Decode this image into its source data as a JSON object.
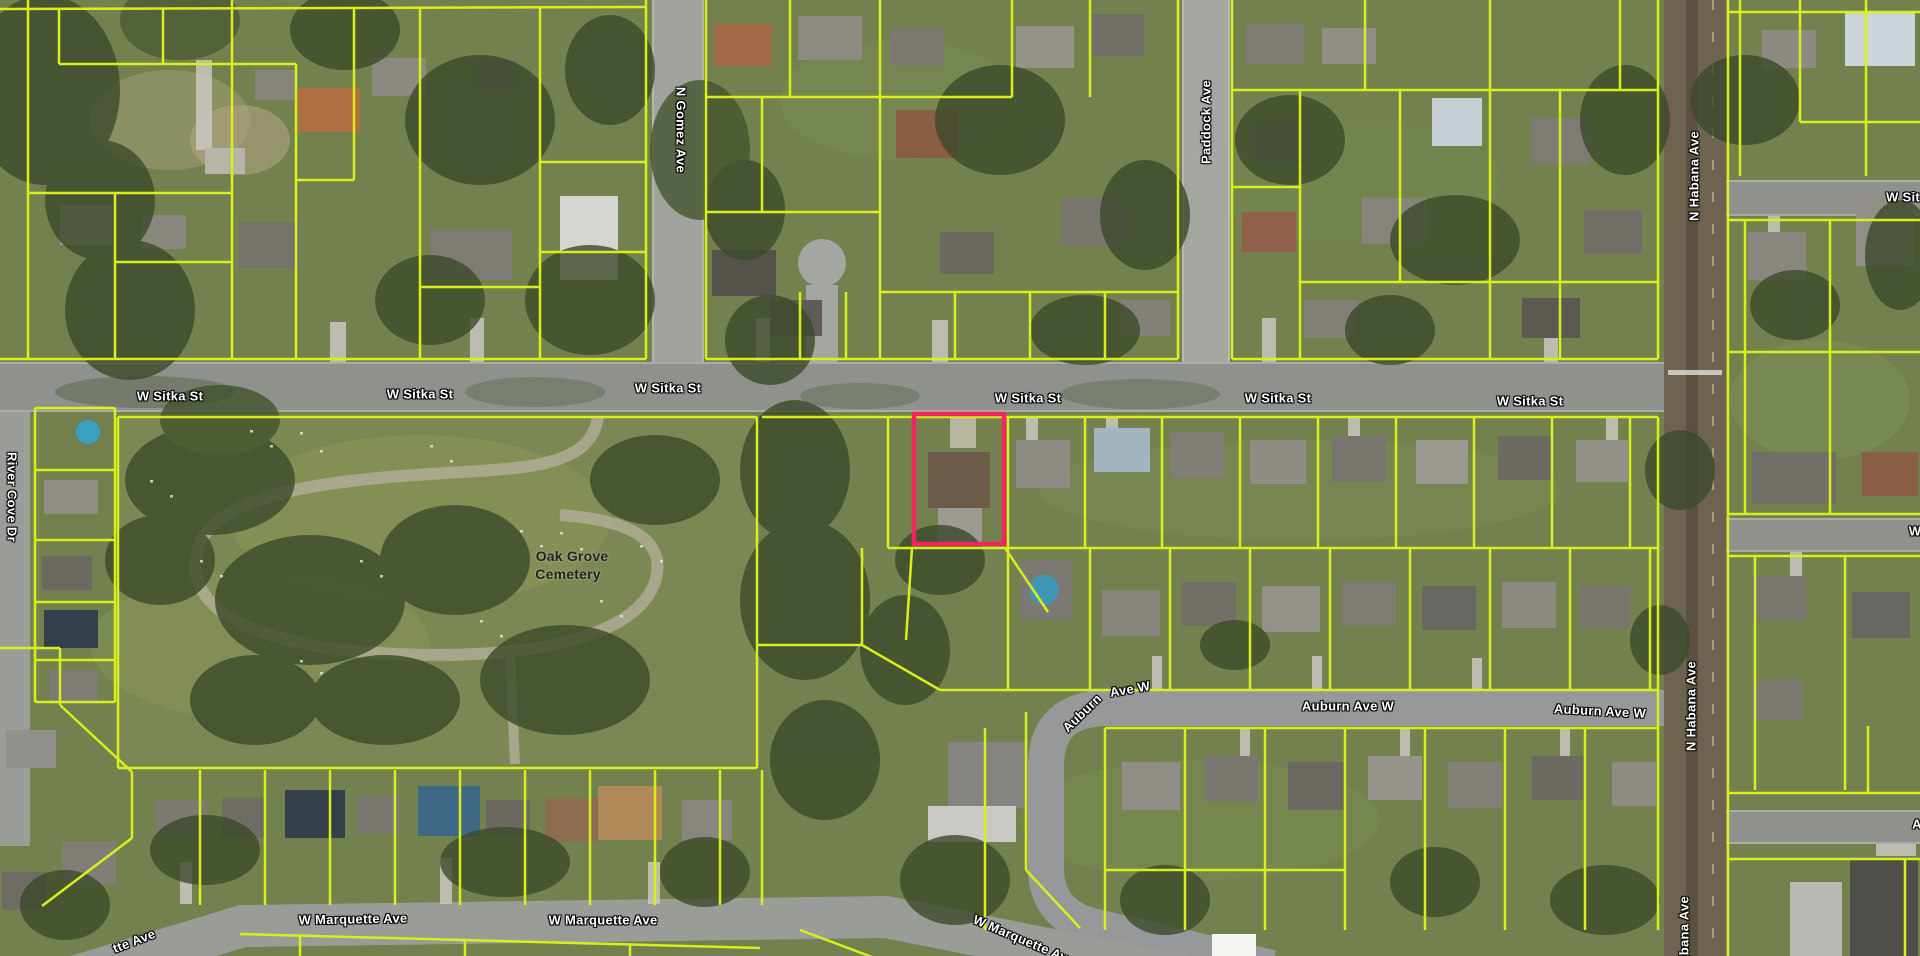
{
  "map": {
    "description": "Aerial parcel map with highlighted property",
    "colors": {
      "parcel_line": "#d9ef1a",
      "highlight": "#f2265f",
      "road": "#969894",
      "label_text": "#ffffff"
    },
    "highlight_parcel": {
      "x": 914,
      "y": 414,
      "w": 90,
      "h": 130
    },
    "labels": [
      {
        "text": "W Sitka St",
        "x": 170,
        "y": 396,
        "rot": 0,
        "kind": "street"
      },
      {
        "text": "W Sitka St",
        "x": 420,
        "y": 394,
        "rot": 0,
        "kind": "street"
      },
      {
        "text": "W Sitka St",
        "x": 668,
        "y": 388,
        "rot": 0,
        "kind": "street"
      },
      {
        "text": "W Sitka St",
        "x": 1028,
        "y": 398,
        "rot": 0,
        "kind": "street"
      },
      {
        "text": "W Sitka St",
        "x": 1278,
        "y": 398,
        "rot": 0,
        "kind": "street"
      },
      {
        "text": "W Sitka St",
        "x": 1530,
        "y": 401,
        "rot": 0,
        "kind": "street"
      },
      {
        "text": "W Sit",
        "x": 1903,
        "y": 197,
        "rot": 0,
        "kind": "street"
      },
      {
        "text": "N Gomez Ave",
        "x": 681,
        "y": 130,
        "rot": 90,
        "kind": "street"
      },
      {
        "text": "Paddock Ave",
        "x": 1206,
        "y": 122,
        "rot": -90,
        "kind": "street"
      },
      {
        "text": "N Habana Ave",
        "x": 1694,
        "y": 176,
        "rot": -90,
        "kind": "street"
      },
      {
        "text": "N Habana Ave",
        "x": 1691,
        "y": 706,
        "rot": -90,
        "kind": "street"
      },
      {
        "text": "N Habana Ave",
        "x": 1684,
        "y": 941,
        "rot": -90,
        "kind": "street"
      },
      {
        "text": "River Cove Dr",
        "x": 12,
        "y": 497,
        "rot": 90,
        "kind": "street"
      },
      {
        "text": "Auburn",
        "x": 1082,
        "y": 713,
        "rot": -44,
        "kind": "street"
      },
      {
        "text": "Ave W",
        "x": 1130,
        "y": 689,
        "rot": -10,
        "kind": "street"
      },
      {
        "text": "Auburn Ave W",
        "x": 1348,
        "y": 706,
        "rot": 0,
        "kind": "street"
      },
      {
        "text": "Auburn Ave W",
        "x": 1600,
        "y": 711,
        "rot": 3,
        "kind": "street"
      },
      {
        "text": "W Marquette Ave",
        "x": 353,
        "y": 919,
        "rot": -1,
        "kind": "street"
      },
      {
        "text": "W Marquette Ave",
        "x": 603,
        "y": 920,
        "rot": 0,
        "kind": "street"
      },
      {
        "text": "W Marquette Ave",
        "x": 1024,
        "y": 940,
        "rot": 23,
        "kind": "street"
      },
      {
        "text": "tte Ave",
        "x": 134,
        "y": 941,
        "rot": -21,
        "kind": "street"
      },
      {
        "text": "W",
        "x": 1915,
        "y": 531,
        "rot": 0,
        "kind": "street"
      },
      {
        "text": "A",
        "x": 1917,
        "y": 824,
        "rot": 0,
        "kind": "street"
      },
      {
        "text": "Oak Grove",
        "x": 572,
        "y": 556,
        "rot": 0,
        "kind": "place"
      },
      {
        "text": "Cemetery",
        "x": 568,
        "y": 574,
        "rot": 0,
        "kind": "place"
      }
    ],
    "parcel_lines": [
      [
        [
          28,
          0
        ],
        [
          28,
          359
        ]
      ],
      [
        [
          0,
          9
        ],
        [
          646,
          7
        ]
      ],
      [
        [
          59,
          9
        ],
        [
          59,
          64
        ]
      ],
      [
        [
          59,
          64
        ],
        [
          232,
          64
        ]
      ],
      [
        [
          163,
          9
        ],
        [
          163,
          64
        ]
      ],
      [
        [
          232,
          0
        ],
        [
          232,
          193
        ]
      ],
      [
        [
          28,
          193
        ],
        [
          232,
          193
        ]
      ],
      [
        [
          232,
          64
        ],
        [
          296,
          64
        ]
      ],
      [
        [
          296,
          64
        ],
        [
          296,
          359
        ]
      ],
      [
        [
          115,
          193
        ],
        [
          115,
          359
        ]
      ],
      [
        [
          115,
          262
        ],
        [
          232,
          262
        ]
      ],
      [
        [
          232,
          193
        ],
        [
          232,
          359
        ]
      ],
      [
        [
          354,
          7
        ],
        [
          354,
          180
        ]
      ],
      [
        [
          296,
          180
        ],
        [
          354,
          180
        ]
      ],
      [
        [
          420,
          7
        ],
        [
          420,
          359
        ]
      ],
      [
        [
          420,
          287
        ],
        [
          540,
          287
        ]
      ],
      [
        [
          540,
          7
        ],
        [
          540,
          359
        ]
      ],
      [
        [
          646,
          0
        ],
        [
          646,
          359
        ]
      ],
      [
        [
          540,
          162
        ],
        [
          646,
          162
        ]
      ],
      [
        [
          540,
          252
        ],
        [
          646,
          252
        ]
      ],
      [
        [
          0,
          359
        ],
        [
          646,
          359
        ]
      ],
      [
        [
          706,
          359
        ],
        [
          1178,
          359
        ]
      ],
      [
        [
          1232,
          359
        ],
        [
          1658,
          359
        ]
      ],
      [
        [
          706,
          0
        ],
        [
          706,
          359
        ]
      ],
      [
        [
          790,
          0
        ],
        [
          790,
          97
        ]
      ],
      [
        [
          880,
          0
        ],
        [
          880,
          359
        ]
      ],
      [
        [
          706,
          97
        ],
        [
          880,
          97
        ]
      ],
      [
        [
          762,
          97
        ],
        [
          762,
          212
        ]
      ],
      [
        [
          706,
          212
        ],
        [
          880,
          212
        ]
      ],
      [
        [
          1012,
          0
        ],
        [
          1012,
          97
        ]
      ],
      [
        [
          880,
          97
        ],
        [
          1012,
          97
        ]
      ],
      [
        [
          1090,
          0
        ],
        [
          1090,
          97
        ]
      ],
      [
        [
          880,
          292
        ],
        [
          1178,
          292
        ]
      ],
      [
        [
          955,
          292
        ],
        [
          955,
          359
        ]
      ],
      [
        [
          1030,
          292
        ],
        [
          1030,
          359
        ]
      ],
      [
        [
          1105,
          292
        ],
        [
          1105,
          359
        ]
      ],
      [
        [
          1178,
          0
        ],
        [
          1178,
          359
        ]
      ],
      [
        [
          800,
          292
        ],
        [
          800,
          359
        ]
      ],
      [
        [
          846,
          292
        ],
        [
          846,
          359
        ]
      ],
      [
        [
          1232,
          0
        ],
        [
          1232,
          359
        ]
      ],
      [
        [
          1658,
          0
        ],
        [
          1658,
          359
        ]
      ],
      [
        [
          1232,
          90
        ],
        [
          1658,
          90
        ]
      ],
      [
        [
          1300,
          90
        ],
        [
          1300,
          359
        ]
      ],
      [
        [
          1365,
          0
        ],
        [
          1365,
          90
        ]
      ],
      [
        [
          1490,
          0
        ],
        [
          1490,
          359
        ]
      ],
      [
        [
          1560,
          90
        ],
        [
          1560,
          359
        ]
      ],
      [
        [
          1620,
          0
        ],
        [
          1620,
          90
        ]
      ],
      [
        [
          1232,
          187
        ],
        [
          1300,
          187
        ]
      ],
      [
        [
          1300,
          282
        ],
        [
          1658,
          282
        ]
      ],
      [
        [
          1400,
          90
        ],
        [
          1400,
          282
        ]
      ],
      [
        [
          1728,
          12
        ],
        [
          1920,
          12
        ]
      ],
      [
        [
          1740,
          0
        ],
        [
          1740,
          176
        ]
      ],
      [
        [
          1800,
          0
        ],
        [
          1800,
          122
        ]
      ],
      [
        [
          1866,
          0
        ],
        [
          1866,
          176
        ]
      ],
      [
        [
          1800,
          122
        ],
        [
          1920,
          122
        ]
      ],
      [
        [
          1728,
          220
        ],
        [
          1920,
          220
        ]
      ],
      [
        [
          1745,
          220
        ],
        [
          1745,
          514
        ]
      ],
      [
        [
          1830,
          220
        ],
        [
          1830,
          514
        ]
      ],
      [
        [
          1728,
          352
        ],
        [
          1920,
          352
        ]
      ],
      [
        [
          1728,
          514
        ],
        [
          1920,
          514
        ]
      ],
      [
        [
          1728,
          556
        ],
        [
          1920,
          556
        ]
      ],
      [
        [
          1755,
          556
        ],
        [
          1755,
          790
        ]
      ],
      [
        [
          1845,
          556
        ],
        [
          1845,
          790
        ]
      ],
      [
        [
          1728,
          793
        ],
        [
          1920,
          793
        ]
      ],
      [
        [
          1728,
          859
        ],
        [
          1920,
          859
        ]
      ],
      [
        [
          1868,
          726
        ],
        [
          1868,
          793
        ]
      ],
      [
        [
          1905,
          859
        ],
        [
          1905,
          956
        ]
      ],
      [
        [
          1728,
          0
        ],
        [
          1728,
          956
        ]
      ],
      [
        [
          118,
          417
        ],
        [
          757,
          417
        ]
      ],
      [
        [
          118,
          417
        ],
        [
          118,
          768
        ]
      ],
      [
        [
          757,
          417
        ],
        [
          757,
          768
        ]
      ],
      [
        [
          118,
          768
        ],
        [
          757,
          768
        ]
      ],
      [
        [
          35,
          408
        ],
        [
          115,
          408
        ]
      ],
      [
        [
          35,
          408
        ],
        [
          35,
          702
        ]
      ],
      [
        [
          115,
          408
        ],
        [
          115,
          702
        ]
      ],
      [
        [
          35,
          470
        ],
        [
          115,
          470
        ]
      ],
      [
        [
          35,
          540
        ],
        [
          115,
          540
        ]
      ],
      [
        [
          35,
          602
        ],
        [
          115,
          602
        ]
      ],
      [
        [
          35,
          660
        ],
        [
          115,
          660
        ]
      ],
      [
        [
          35,
          702
        ],
        [
          115,
          702
        ]
      ],
      [
        [
          0,
          648
        ],
        [
          60,
          648
        ]
      ],
      [
        [
          60,
          648
        ],
        [
          60,
          705
        ]
      ],
      [
        [
          60,
          705
        ],
        [
          132,
          772
        ]
      ],
      [
        [
          132,
          772
        ],
        [
          132,
          838
        ]
      ],
      [
        [
          132,
          838
        ],
        [
          42,
          906
        ]
      ],
      [
        [
          762,
          417
        ],
        [
          1658,
          417
        ]
      ],
      [
        [
          888,
          417
        ],
        [
          888,
          548
        ]
      ],
      [
        [
          1008,
          417
        ],
        [
          1008,
          548
        ]
      ],
      [
        [
          1085,
          417
        ],
        [
          1085,
          548
        ]
      ],
      [
        [
          1162,
          417
        ],
        [
          1162,
          548
        ]
      ],
      [
        [
          1240,
          417
        ],
        [
          1240,
          548
        ]
      ],
      [
        [
          1318,
          417
        ],
        [
          1318,
          548
        ]
      ],
      [
        [
          1396,
          417
        ],
        [
          1396,
          548
        ]
      ],
      [
        [
          1474,
          417
        ],
        [
          1474,
          548
        ]
      ],
      [
        [
          1552,
          417
        ],
        [
          1552,
          548
        ]
      ],
      [
        [
          1630,
          417
        ],
        [
          1630,
          548
        ]
      ],
      [
        [
          888,
          548
        ],
        [
          1658,
          548
        ]
      ],
      [
        [
          1008,
          548
        ],
        [
          1008,
          690
        ]
      ],
      [
        [
          1090,
          548
        ],
        [
          1090,
          690
        ]
      ],
      [
        [
          1170,
          548
        ],
        [
          1170,
          690
        ]
      ],
      [
        [
          1250,
          548
        ],
        [
          1250,
          690
        ]
      ],
      [
        [
          1330,
          548
        ],
        [
          1330,
          690
        ]
      ],
      [
        [
          1410,
          548
        ],
        [
          1410,
          690
        ]
      ],
      [
        [
          1490,
          548
        ],
        [
          1490,
          690
        ]
      ],
      [
        [
          1570,
          548
        ],
        [
          1570,
          690
        ]
      ],
      [
        [
          1650,
          548
        ],
        [
          1650,
          690
        ]
      ],
      [
        [
          940,
          690
        ],
        [
          1658,
          690
        ]
      ],
      [
        [
          862,
          548
        ],
        [
          862,
          645
        ]
      ],
      [
        [
          757,
          645
        ],
        [
          862,
          645
        ]
      ],
      [
        [
          862,
          645
        ],
        [
          940,
          690
        ]
      ],
      [
        [
          912,
          548
        ],
        [
          906,
          640
        ]
      ],
      [
        [
          1005,
          548
        ],
        [
          1048,
          612
        ]
      ],
      [
        [
          1105,
          728
        ],
        [
          1658,
          728
        ]
      ],
      [
        [
          1105,
          728
        ],
        [
          1105,
          930
        ]
      ],
      [
        [
          1185,
          728
        ],
        [
          1185,
          930
        ]
      ],
      [
        [
          1265,
          728
        ],
        [
          1265,
          930
        ]
      ],
      [
        [
          1345,
          728
        ],
        [
          1345,
          930
        ]
      ],
      [
        [
          1425,
          728
        ],
        [
          1425,
          930
        ]
      ],
      [
        [
          1505,
          728
        ],
        [
          1505,
          930
        ]
      ],
      [
        [
          1585,
          728
        ],
        [
          1585,
          930
        ]
      ],
      [
        [
          1105,
          870
        ],
        [
          1345,
          870
        ]
      ],
      [
        [
          1658,
          417
        ],
        [
          1658,
          930
        ]
      ],
      [
        [
          985,
          728
        ],
        [
          985,
          930
        ]
      ],
      [
        [
          762,
          770
        ],
        [
          762,
          905
        ]
      ],
      [
        [
          200,
          770
        ],
        [
          200,
          905
        ]
      ],
      [
        [
          265,
          770
        ],
        [
          265,
          905
        ]
      ],
      [
        [
          330,
          770
        ],
        [
          330,
          905
        ]
      ],
      [
        [
          395,
          770
        ],
        [
          395,
          905
        ]
      ],
      [
        [
          460,
          770
        ],
        [
          460,
          905
        ]
      ],
      [
        [
          525,
          770
        ],
        [
          525,
          905
        ]
      ],
      [
        [
          590,
          770
        ],
        [
          590,
          905
        ]
      ],
      [
        [
          655,
          770
        ],
        [
          655,
          905
        ]
      ],
      [
        [
          720,
          770
        ],
        [
          720,
          905
        ]
      ],
      [
        [
          240,
          934
        ],
        [
          760,
          948
        ]
      ],
      [
        [
          300,
          936
        ],
        [
          300,
          956
        ]
      ],
      [
        [
          465,
          940
        ],
        [
          465,
          956
        ]
      ],
      [
        [
          630,
          944
        ],
        [
          630,
          956
        ]
      ],
      [
        [
          800,
          930
        ],
        [
          880,
          960
        ]
      ],
      [
        [
          1026,
          712
        ],
        [
          1026,
          870
        ]
      ],
      [
        [
          1026,
          870
        ],
        [
          1080,
          928
        ]
      ]
    ]
  }
}
